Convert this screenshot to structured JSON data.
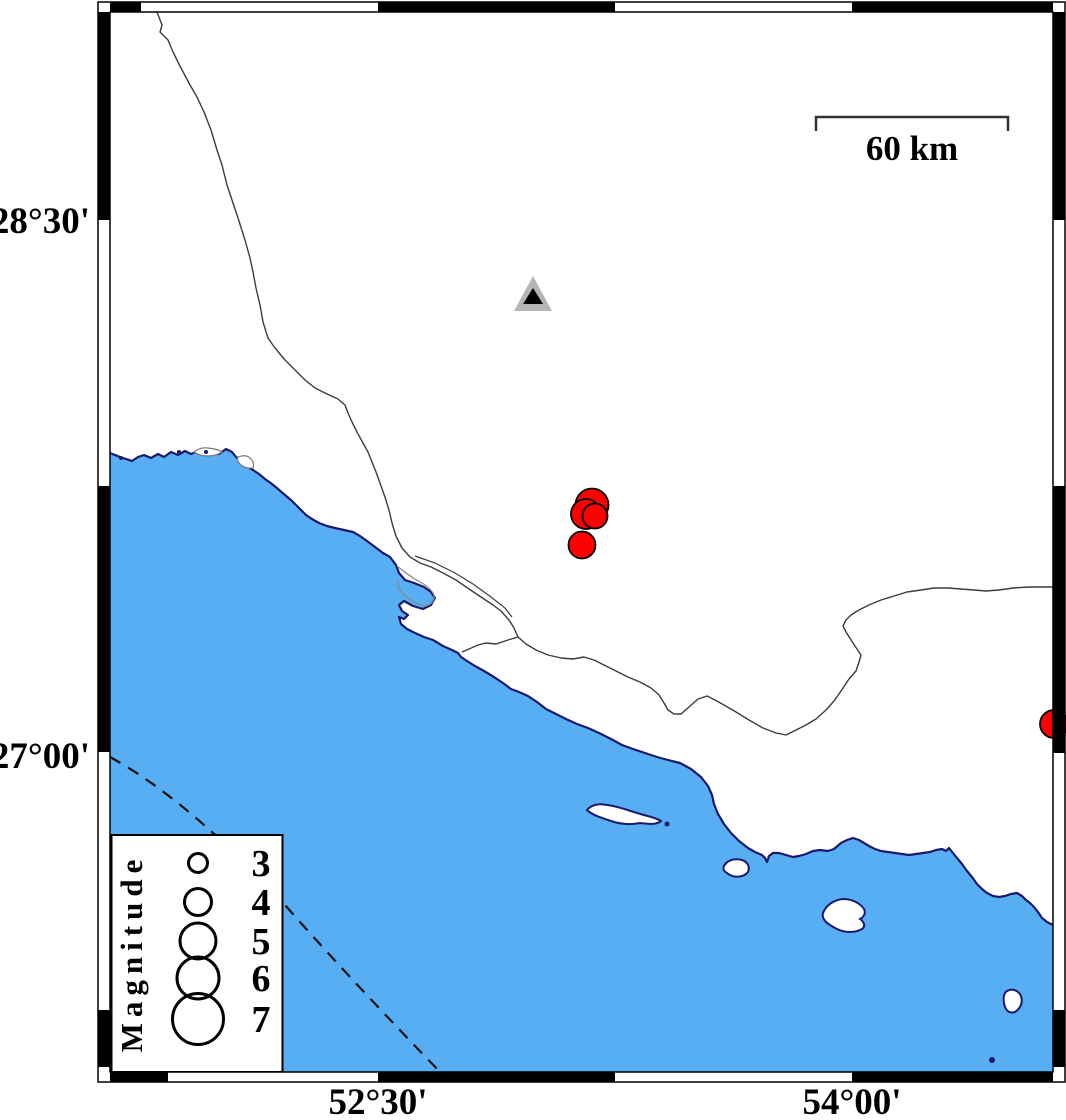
{
  "map": {
    "title": "Seismicity map with coastline, epicenters and station",
    "frame": {
      "lat_labels": [
        {
          "text": "28°30'",
          "y": 220
        },
        {
          "text": "27°00'",
          "y": 755
        }
      ],
      "lon_labels": [
        {
          "text": "52°30'",
          "x": 378
        },
        {
          "text": "54°00'",
          "x": 852
        }
      ]
    },
    "scale_bar": {
      "label": "60 km"
    },
    "legend": {
      "title": "Magnitude",
      "entries": [
        {
          "label": "3",
          "cy": 863,
          "r": 9.5
        },
        {
          "label": "4",
          "cy": 902,
          "r": 13.5
        },
        {
          "label": "5",
          "cy": 941,
          "r": 18
        },
        {
          "label": "6",
          "cy": 978,
          "r": 21
        },
        {
          "label": "7",
          "cy": 1019,
          "r": 25.5
        }
      ]
    },
    "earthquakes": [
      {
        "x": 592,
        "y": 505,
        "r": 16.5
      },
      {
        "x": 586,
        "y": 514,
        "r": 15
      },
      {
        "x": 595,
        "y": 516,
        "r": 12.5
      },
      {
        "x": 582,
        "y": 545,
        "r": 13.5
      },
      {
        "x": 1054,
        "y": 724,
        "r": 14
      }
    ],
    "station": {
      "symbol": "triangle",
      "x": 533,
      "y": 296
    },
    "colors": {
      "sea": "#58AEF3",
      "land": "#FFFFFF",
      "coastline": "#1A1A6B",
      "earthquake": "#FF0000",
      "station_outer": "#B5B5B5",
      "station_inner": "#000000",
      "boundary_line": "#3C3C3C",
      "frame": "#000000"
    }
  }
}
